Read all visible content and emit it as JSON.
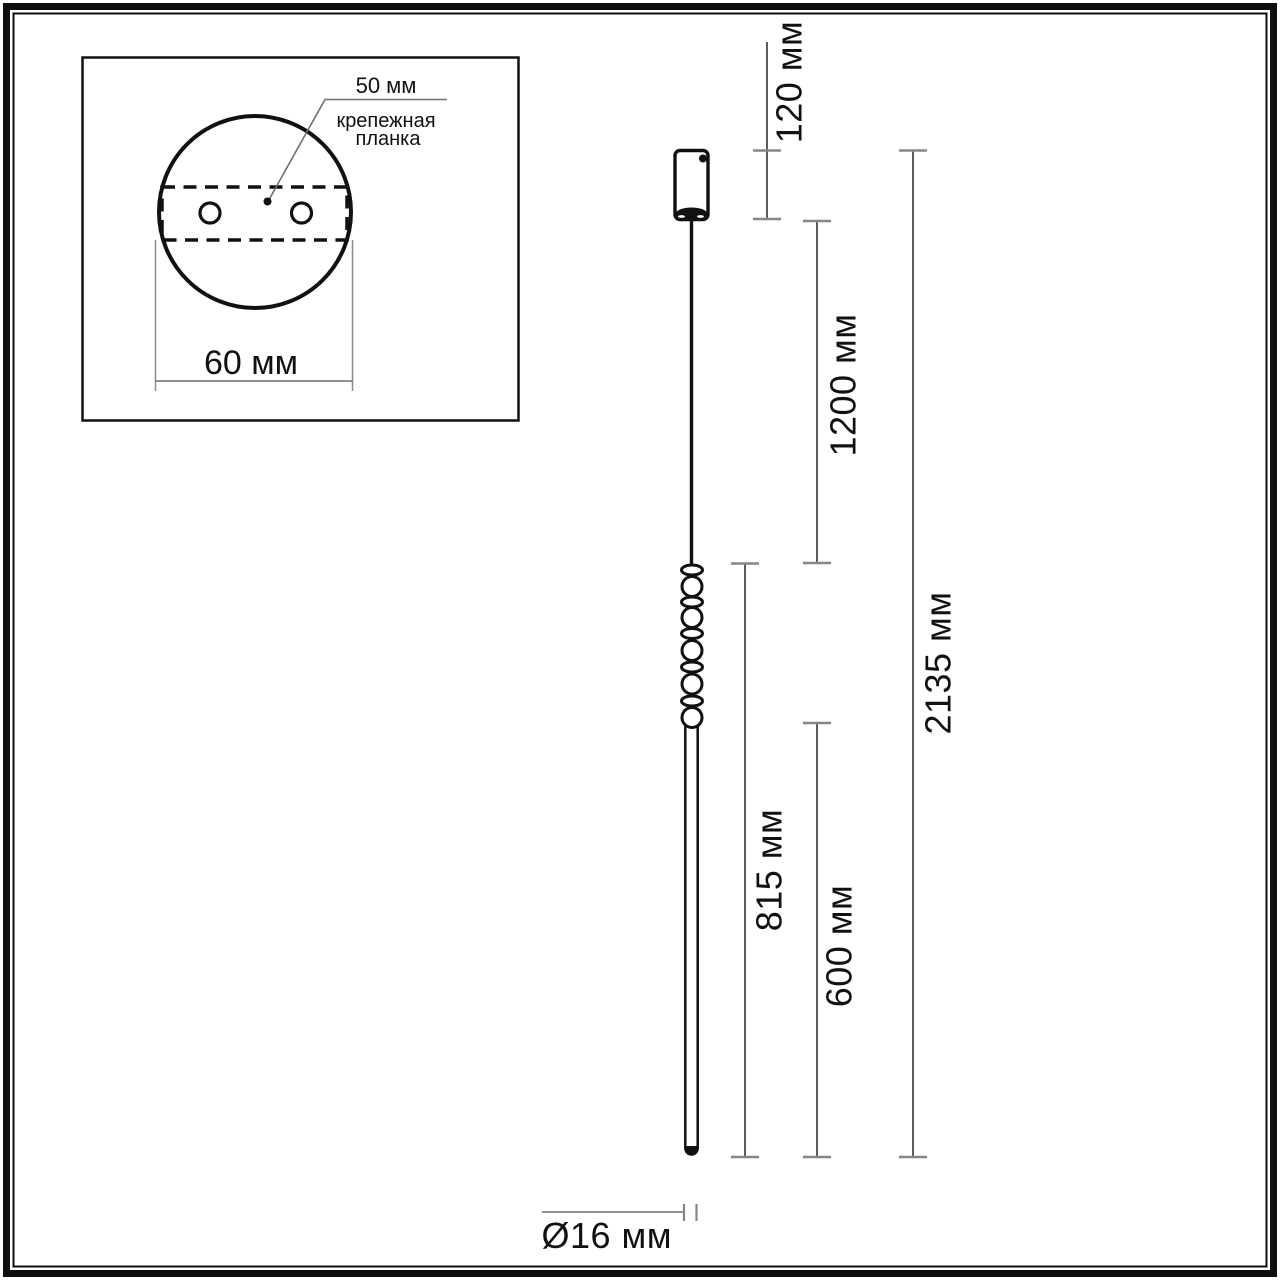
{
  "title": "Pendant light dimensional drawing",
  "inset": {
    "hole_spacing_label": "50 мм",
    "plate_label_line1": "крепежная",
    "plate_label_line2": "планка",
    "canopy_width_label": "60 мм"
  },
  "dimensions": {
    "canopy_height": "120 мм",
    "cable_length": "1200 мм",
    "overall_height": "2135 мм",
    "stem_with_beads": "815 мм",
    "tube_length": "600 мм",
    "tube_diameter": "Ø16 мм"
  },
  "colors": {
    "drawing_line": "#111111",
    "dimension_line": "#3f3f3f",
    "tick": "#868686",
    "background": "#ffffff"
  }
}
